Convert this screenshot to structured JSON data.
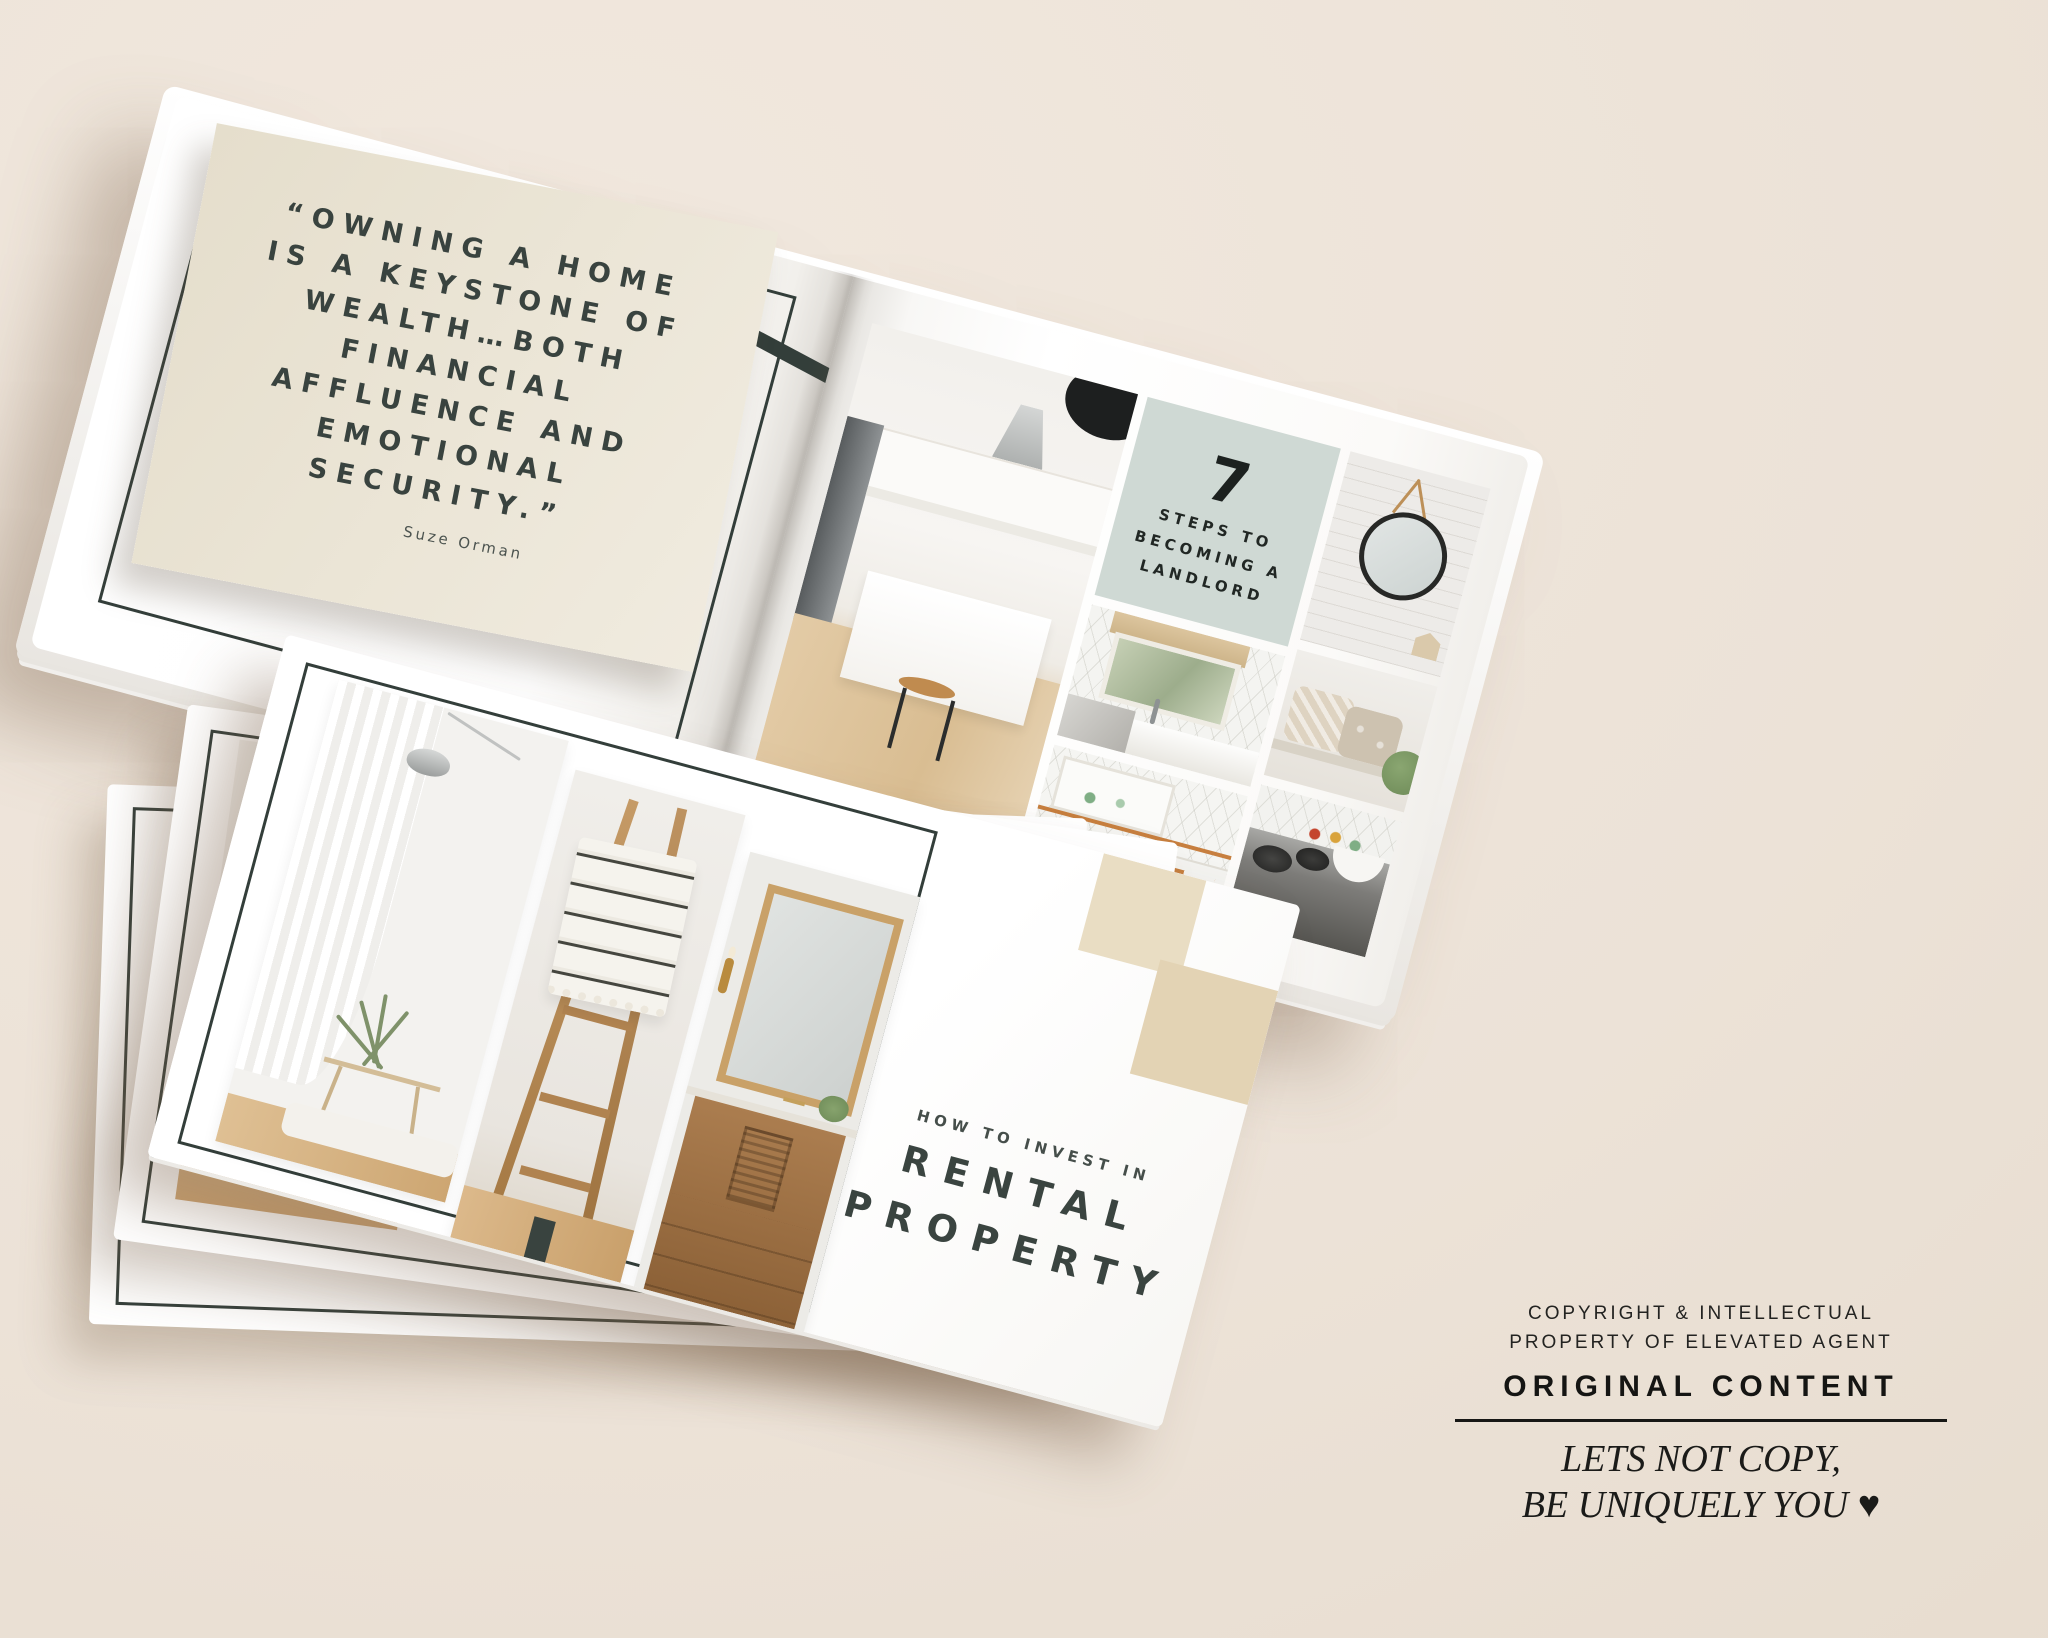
{
  "scene": {
    "description": "mockup of landscape real-estate guide booklets on beige surface"
  },
  "colors": {
    "background": "#ece2d7",
    "ink": "#333e3a",
    "quote_ink": "#39433f",
    "sage": "#cfd9d4",
    "card_beige": "#e9e3d3",
    "square_light": "#e9ddc3",
    "square_dark": "#e3d3b4",
    "copyright_ink": "#1e1e1c",
    "copper": "#c77f3f",
    "wood": "#c9a06b"
  },
  "open_book": {
    "left_page": {
      "quote_lines": [
        "“OWNING A HOME",
        "IS A KEYSTONE OF",
        "WEALTH…BOTH",
        "FINANCIAL",
        "AFFLUENCE AND",
        "EMOTIONAL",
        "SECURITY.”"
      ],
      "attribution": "Suze Orman"
    },
    "right_page": {
      "badge": {
        "number": "7",
        "lines": [
          "STEPS TO",
          "BECOMING A",
          "LANDLORD"
        ]
      },
      "photos": [
        "kitchen-overview",
        "kitchen-sink-window",
        "kitchen-cabinets",
        "room-round-mirror",
        "bench-pillows",
        "stove-cookware"
      ]
    }
  },
  "book_stack": {
    "books_visible": 3,
    "cover": {
      "eyebrow": "HOW TO INVEST IN",
      "title_lines": [
        "RENTAL",
        "PROPERTY"
      ],
      "photos": [
        "living-room-plant",
        "blanket-ladder",
        "bathroom-vanity"
      ]
    }
  },
  "copyright": {
    "line1": "COPYRIGHT & INTELLECTUAL",
    "line2": "PROPERTY OF ELEVATED AGENT",
    "original_content": "ORIGINAL CONTENT",
    "tagline_line1": "LETS NOT COPY,",
    "tagline_line2": "BE UNIQUELY YOU ♥"
  }
}
